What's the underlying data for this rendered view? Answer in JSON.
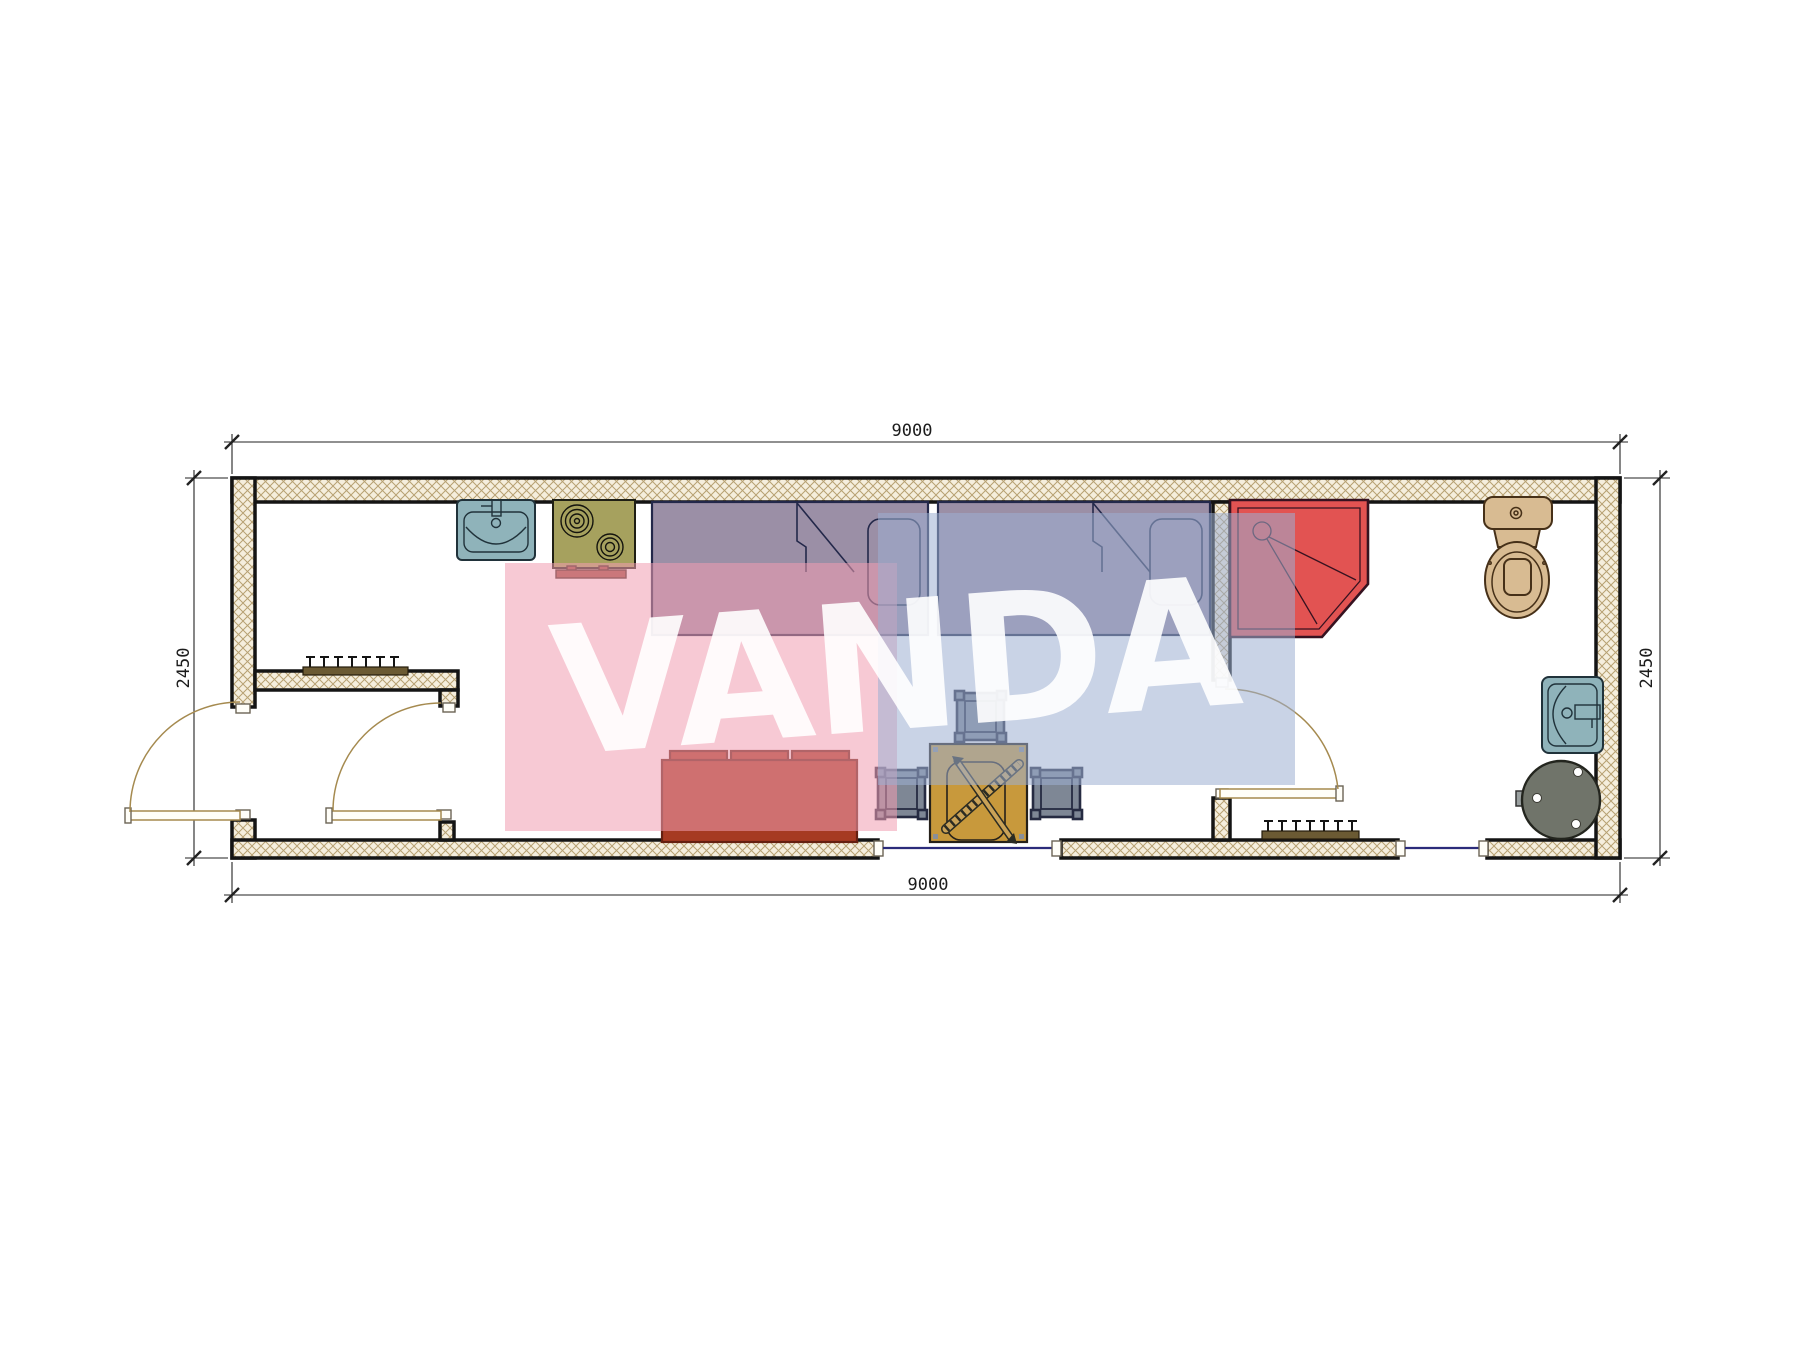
{
  "watermark": {
    "text": "VANDA"
  },
  "dimensions": {
    "top": "9000",
    "bottom": "9000",
    "left": "2450",
    "right": "2450"
  },
  "palette": {
    "wall-line": "#141414",
    "wall-hatch-bg": "#f5eedd",
    "wall-hatch-line": "#b7a172",
    "bed": "#9b8fa6",
    "bed-line": "#23284a",
    "shower": "#e25352",
    "shower-line": "#361220",
    "sofa": "#a63a22",
    "sofa-line": "#651f10",
    "table": "#c8993c",
    "stick": "#caa257",
    "stool": "#7e8795",
    "fixture-teal": "#8fb3ba",
    "stove": "#a6a15e",
    "stove-handle": "#9c4a3a",
    "toilet": "#d8bb92",
    "toilet-line": "#463018",
    "boiler": "#70746a",
    "coat-rack": "#6b5a33",
    "door-arc": "#a58a4f",
    "window-line": "#2b2b7a",
    "dim-line": "#222222",
    "watermark-pink": "rgba(240,157,177,0.55)",
    "watermark-blue": "rgba(157,175,210,0.55)"
  }
}
